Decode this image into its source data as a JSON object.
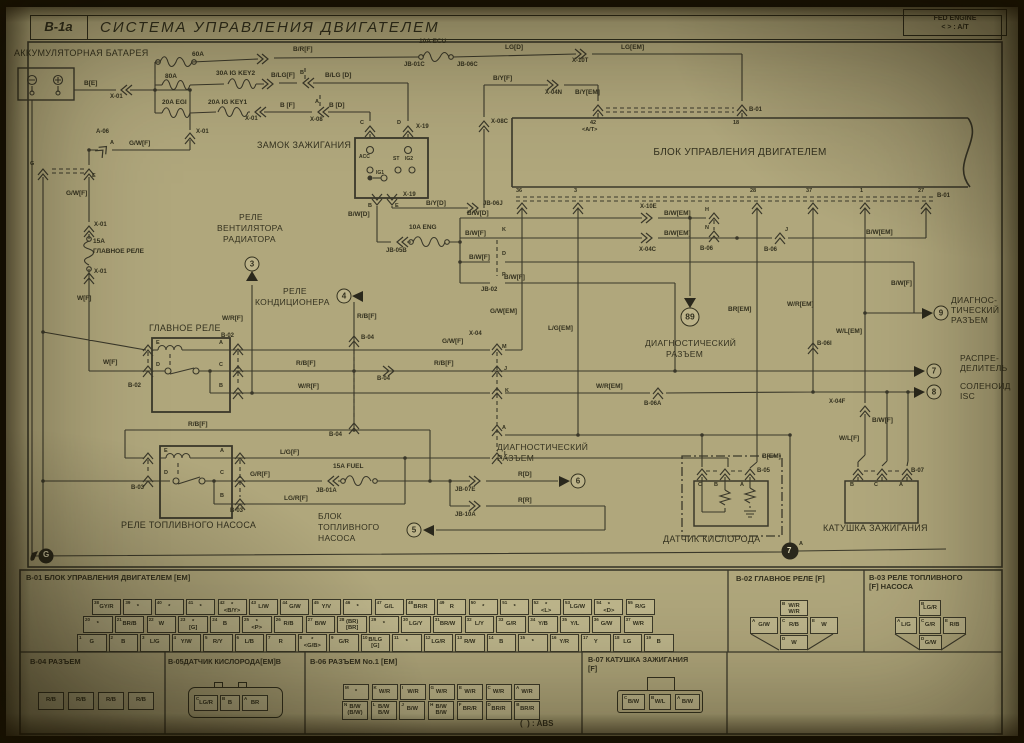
{
  "header": {
    "code": "B-1a",
    "title": "СИСТЕМА УПРАВЛЕНИЯ ДВИГАТЕЛЕМ",
    "corner1": "FED ENGINE",
    "corner2": "<  > : A/T"
  },
  "labels": [
    [
      "АККУМУЛЯТОРНАЯ БАТАРЕЯ",
      14,
      49,
      9,
      "r"
    ],
    [
      "60A",
      192,
      52,
      6.5
    ],
    [
      "B[E]",
      84,
      81
    ],
    [
      "X-01",
      110,
      94,
      6
    ],
    [
      "80A",
      165,
      74
    ],
    [
      "30A IG KEY2",
      216,
      71
    ],
    [
      "20A EGI",
      162,
      100
    ],
    [
      "20A IG KEY1",
      208,
      100
    ],
    [
      "X-01",
      245,
      116,
      6
    ],
    [
      "B [F]",
      280,
      103
    ],
    [
      "A",
      315,
      100,
      5.5
    ],
    [
      "X-08",
      310,
      117,
      6
    ],
    [
      "B [D]",
      329,
      103
    ],
    [
      "B",
      300,
      71,
      5.5
    ],
    [
      "B/LG[F]",
      271,
      73
    ],
    [
      "B/LG [D]",
      325,
      73
    ],
    [
      "B/R[F]",
      293,
      47
    ],
    [
      "10A ECU",
      419,
      39
    ],
    [
      "JB-01C",
      404,
      62,
      6
    ],
    [
      "JB-06C",
      457,
      62,
      6
    ],
    [
      "LG[D]",
      505,
      45
    ],
    [
      "X-10T",
      572,
      58,
      6
    ],
    [
      "LG[EM]",
      621,
      45
    ],
    [
      "B/Y[F]",
      493,
      76
    ],
    [
      "X-04N",
      545,
      90,
      6
    ],
    [
      "B/Y[EM]",
      575,
      90
    ],
    [
      "X-08C",
      491,
      119,
      6
    ],
    [
      "C",
      360,
      121,
      5.5
    ],
    [
      "D",
      397,
      121,
      5.5
    ],
    [
      "X-19",
      416,
      124,
      6
    ],
    [
      "ЗАМОК ЗАЖИГАНИЯ",
      257,
      141,
      9,
      "r"
    ],
    [
      "ACC",
      359,
      155,
      5
    ],
    [
      "IG1",
      376,
      171,
      5
    ],
    [
      "ST",
      393,
      157,
      5
    ],
    [
      "IG2",
      405,
      157,
      5
    ],
    [
      "B",
      368,
      204,
      5.5
    ],
    [
      "E",
      395,
      204,
      5.5
    ],
    [
      "X-19",
      403,
      192,
      6
    ],
    [
      "B/W[D]",
      348,
      212
    ],
    [
      "B/Y[D]",
      426,
      201
    ],
    [
      "JB-06J",
      483,
      201,
      6
    ],
    [
      "10A ENG",
      409,
      225
    ],
    [
      "JB-05B",
      386,
      248,
      6
    ],
    [
      "42",
      590,
      121,
      5.5
    ],
    [
      "<A/T>",
      582,
      128,
      5.5
    ],
    [
      "18",
      733,
      121,
      5.5
    ],
    [
      "B-01",
      749,
      107,
      6
    ],
    [
      "БЛОК УПРАВЛЕНИЯ ДВИГАТЕЛЕМ",
      740,
      148,
      10,
      "rc"
    ],
    [
      "36",
      516,
      189,
      5.5
    ],
    [
      "3",
      574,
      189,
      5.5
    ],
    [
      "28",
      750,
      189,
      5.5
    ],
    [
      "37",
      806,
      189,
      5.5
    ],
    [
      "1",
      860,
      189,
      5.5
    ],
    [
      "27",
      918,
      189,
      5.5
    ],
    [
      "B-01",
      937,
      193,
      6
    ],
    [
      "B/W[D]",
      467,
      211
    ],
    [
      "X-10E",
      640,
      204,
      6
    ],
    [
      "B/W[EM]",
      664,
      211
    ],
    [
      "H",
      705,
      208,
      5.5
    ],
    [
      "N",
      705,
      226,
      5.5
    ],
    [
      "B-06",
      700,
      246,
      6
    ],
    [
      "B/W[F]",
      465,
      231
    ],
    [
      "X-04C",
      639,
      247,
      6
    ],
    [
      "B/W[EM]",
      664,
      231
    ],
    [
      "J",
      785,
      228,
      5.5
    ],
    [
      "B-06",
      764,
      247,
      6
    ],
    [
      "B/W[EM]",
      866,
      230
    ],
    [
      "B/W[F]",
      469,
      255
    ],
    [
      "B/W[F]",
      504,
      275
    ],
    [
      "K",
      502,
      228,
      5.5
    ],
    [
      "D",
      502,
      252,
      5.5
    ],
    [
      "P",
      502,
      273,
      5.5
    ],
    [
      "JB-02",
      481,
      287,
      6
    ],
    [
      "G/W[EM]",
      490,
      309
    ],
    [
      "L/G[EM]",
      548,
      326
    ],
    [
      "BR[EM]",
      728,
      307
    ],
    [
      "W/R[EM]",
      787,
      302
    ],
    [
      "W/L[EM]",
      836,
      329
    ],
    [
      "B/W[F]",
      891,
      281
    ],
    [
      "B-06I",
      817,
      341,
      6
    ],
    [
      "B-06A",
      644,
      401,
      6
    ],
    [
      "W/R[EM]",
      596,
      384
    ],
    [
      "ДИАГНОСТИЧЕСКИЙ",
      645,
      339,
      8.5,
      "r"
    ],
    [
      "РАЗЪЕМ",
      666,
      350,
      8.5,
      "r"
    ],
    [
      "ДИАГНОС-",
      951,
      296,
      8.5,
      "r"
    ],
    [
      "ТИЧЕСКИЙ",
      951,
      306,
      8.5,
      "r"
    ],
    [
      "РАЗЪЕМ",
      951,
      316,
      8.5,
      "r"
    ],
    [
      "РАСПРЕ-",
      960,
      354,
      8.5,
      "r"
    ],
    [
      "ДЕЛИТЕЛЬ",
      960,
      364,
      8.5,
      "r"
    ],
    [
      "СОЛЕНОИД",
      960,
      382,
      8.5,
      "r"
    ],
    [
      "ISC",
      960,
      392,
      8.5,
      "r"
    ],
    [
      "X-04F",
      829,
      399,
      6
    ],
    [
      "W/L[F]",
      839,
      436
    ],
    [
      "B/W[F]",
      872,
      418
    ],
    [
      "B[EM]",
      762,
      454
    ],
    [
      "A",
      799,
      542,
      5.5
    ],
    [
      "7",
      787,
      547,
      8,
      "w"
    ],
    [
      "G",
      43,
      551,
      8,
      "w"
    ],
    [
      "A-06",
      96,
      129,
      6
    ],
    [
      "A",
      110,
      141,
      5.5
    ],
    [
      "G/W[F]",
      129,
      141
    ],
    [
      "X-01",
      196,
      129,
      6
    ],
    [
      "G",
      30,
      162,
      5.5
    ],
    [
      "E",
      92,
      174,
      5.5
    ],
    [
      "G/W[F]",
      66,
      191
    ],
    [
      "X-01",
      94,
      222,
      6
    ],
    [
      "15A",
      93,
      239
    ],
    [
      "ГЛАВНОЕ РЕЛЕ",
      93,
      249
    ],
    [
      "X-01",
      94,
      269,
      6
    ],
    [
      "W[F]",
      77,
      296
    ],
    [
      "РЕЛЕ",
      239,
      213,
      8.5,
      "r"
    ],
    [
      "ВЕНТИЛЯТОРА",
      217,
      224,
      8.5,
      "r"
    ],
    [
      "РАДИАТОРА",
      223,
      235,
      8.5,
      "r"
    ],
    [
      "W/R[F]",
      222,
      316
    ],
    [
      "ГЛАВНОЕ РЕЛЕ",
      149,
      324,
      9,
      "r"
    ],
    [
      "РЕЛЕ",
      283,
      287,
      8.5,
      "r"
    ],
    [
      "КОНДИЦИОНЕРА",
      255,
      298,
      8.5,
      "r"
    ],
    [
      "R/B[F]",
      357,
      314
    ],
    [
      "B-04",
      361,
      335,
      6
    ],
    [
      "E",
      156,
      341,
      5.5
    ],
    [
      "A",
      219,
      341,
      5.5
    ],
    [
      "D",
      156,
      363,
      5.5
    ],
    [
      "C",
      219,
      363,
      5.5
    ],
    [
      "B",
      219,
      384,
      5.5
    ],
    [
      "B-02",
      221,
      333,
      6
    ],
    [
      "B-02",
      128,
      383,
      6
    ],
    [
      "W[F]",
      103,
      360
    ],
    [
      "G/W[F]",
      442,
      339
    ],
    [
      "R/B[F]",
      296,
      361
    ],
    [
      "B-04",
      377,
      376,
      6
    ],
    [
      "R/B[F]",
      434,
      361
    ],
    [
      "W/R[F]",
      298,
      384
    ],
    [
      "M",
      502,
      345,
      5.5
    ],
    [
      "J",
      504,
      367,
      5.5
    ],
    [
      "K",
      505,
      389,
      5.5
    ],
    [
      "A",
      502,
      426,
      5.5
    ],
    [
      "L",
      504,
      452,
      5.5
    ],
    [
      "X-04",
      469,
      331,
      6
    ],
    [
      "B-04",
      329,
      432,
      6
    ],
    [
      "R/B[F]",
      188,
      422
    ],
    [
      "E",
      164,
      449,
      5.5
    ],
    [
      "A",
      220,
      449,
      5.5
    ],
    [
      "D",
      164,
      471,
      5.5
    ],
    [
      "C",
      220,
      471,
      5.5
    ],
    [
      "B",
      220,
      494,
      5.5
    ],
    [
      "B-03",
      131,
      485,
      6
    ],
    [
      "B-03",
      230,
      508,
      6
    ],
    [
      "L/G[F]",
      280,
      450
    ],
    [
      "G/R[F]",
      250,
      472
    ],
    [
      "15A FUEL",
      333,
      464
    ],
    [
      "JB-01A",
      316,
      488,
      6
    ],
    [
      "LG/R[F]",
      284,
      496
    ],
    [
      "JB-07E",
      455,
      487,
      6
    ],
    [
      "JB-10A",
      455,
      512,
      6
    ],
    [
      "R[D]",
      518,
      472
    ],
    [
      "R[R]",
      518,
      498
    ],
    [
      "РЕЛЕ ТОПЛИВНОГО НАСОСА",
      121,
      521,
      9,
      "r"
    ],
    [
      "БЛОК",
      318,
      512,
      8.5,
      "r"
    ],
    [
      "ТОПЛИВНОГО",
      318,
      523,
      8.5,
      "r"
    ],
    [
      "НАСОСА",
      318,
      534,
      8.5,
      "r"
    ],
    [
      "ДИАГНОСТИЧЕСКИЙ",
      497,
      443,
      8.5,
      "r"
    ],
    [
      "РАЗЪЕМ",
      497,
      454,
      8.5,
      "r"
    ],
    [
      "C",
      698,
      483,
      5.5
    ],
    [
      "B",
      714,
      483,
      5.5
    ],
    [
      "A",
      740,
      483,
      5.5
    ],
    [
      "B-05",
      757,
      468,
      6
    ],
    [
      "ДАТЧИК КИСЛОРОДА",
      663,
      535,
      9,
      "r"
    ],
    [
      "B",
      850,
      483,
      5.5
    ],
    [
      "C",
      874,
      483,
      5.5
    ],
    [
      "A",
      899,
      483,
      5.5
    ],
    [
      "B-07",
      911,
      468,
      6
    ],
    [
      "КАТУШКА ЗАЖИГАНИЯ",
      823,
      524,
      9,
      "r"
    ],
    [
      "B-01 БЛОК УПРАВЛЕНИЯ ДВИГАТЕЛЕМ [EM]",
      26,
      574,
      7.5
    ],
    [
      "B-02 ГЛАВНОЕ РЕЛЕ [F]",
      736,
      575,
      7.5
    ],
    [
      "B-03 РЕЛЕ ТОПЛИВНОГО",
      869,
      574,
      7.5
    ],
    [
      "[F] НАСОСА",
      869,
      583,
      7.5
    ],
    [
      "B-04 РАЗЪЕМ",
      30,
      658,
      7.5
    ],
    [
      "B-05ДАТЧИК КИСЛОРОДА[EM]B",
      168,
      658,
      7.2
    ],
    [
      "B-06 РАЗЪЕМ No.1 [EM]",
      310,
      658,
      7.5
    ],
    [
      "B-07 КАТУШКА ЗАЖИГАНИЯ",
      588,
      656,
      7.2
    ],
    [
      "[F]",
      588,
      665,
      7.2
    ],
    [
      "(  ) : ABS",
      520,
      720,
      8
    ]
  ],
  "circles": [
    [
      "3",
      252,
      264,
      ""
    ],
    [
      "4",
      344,
      296,
      ""
    ],
    [
      "89",
      690,
      317,
      "g"
    ],
    [
      "9",
      941,
      313,
      ""
    ],
    [
      "7",
      934,
      371,
      ""
    ],
    [
      "8",
      934,
      392,
      ""
    ],
    [
      "6",
      578,
      481,
      ""
    ],
    [
      "5",
      414,
      530,
      ""
    ]
  ],
  "legend": {
    "b01": {
      "rows": [
        {
          "x": 92,
          "y": 599,
          "w": 29,
          "step": 31.4,
          "h": 16,
          "start": 38,
          "labels": [
            "GY/R",
            "*",
            "*",
            "*",
            "*|<B/Y>",
            "L/W",
            "G/W",
            "Y/V",
            "*",
            "G/L",
            "BR/R",
            "R",
            "*",
            "*",
            "*|<L>",
            "LG/W",
            "*|<D>",
            "R/G"
          ]
        },
        {
          "x": 83,
          "y": 616,
          "w": 29.5,
          "step": 31.8,
          "h": 17,
          "start": 20,
          "labels": [
            "*",
            "BR/B",
            "W",
            "*|[G]",
            "B",
            "*|<P>",
            "R/B",
            "B/W",
            "(BR)|[BR]",
            "*",
            "LG/Y",
            "BR/W",
            "L/Y",
            "G/R",
            "Y/B",
            "Y/L",
            "G/W",
            "W/R"
          ]
        },
        {
          "x": 77,
          "y": 634,
          "w": 29.5,
          "step": 31.5,
          "h": 18,
          "start": 1,
          "labels": [
            "G",
            "B",
            "L/G",
            "Y/W",
            "R/Y",
            "L/B",
            "R",
            "*|<G/B>",
            "G/R",
            "B/LG|[G]",
            "*",
            "LG/R",
            "R/W",
            "B",
            "*",
            "Y/R",
            "Y",
            "LG",
            "B"
          ]
        }
      ]
    },
    "b02": {
      "cells": [
        {
          "x": 780,
          "y": 600,
          "w": 28,
          "h": 16,
          "l": "W/R|W/R",
          "p": "B"
        },
        {
          "x": 750,
          "y": 617,
          "w": 28,
          "h": 17,
          "l": "G/W",
          "p": "A"
        },
        {
          "x": 780,
          "y": 617,
          "w": 28,
          "h": 17,
          "l": "R/B",
          "p": "C"
        },
        {
          "x": 810,
          "y": 617,
          "w": 28,
          "h": 17,
          "l": "W",
          "p": "E"
        },
        {
          "x": 780,
          "y": 635,
          "w": 28,
          "h": 15,
          "l": "W",
          "p": "D"
        }
      ]
    },
    "b03": {
      "cells": [
        {
          "x": 919,
          "y": 600,
          "w": 22,
          "h": 16,
          "l": "LG/R",
          "p": "B"
        },
        {
          "x": 895,
          "y": 617,
          "w": 22,
          "h": 17,
          "l": "L/G",
          "p": "A"
        },
        {
          "x": 919,
          "y": 617,
          "w": 22,
          "h": 17,
          "l": "G/R",
          "p": "C"
        },
        {
          "x": 943,
          "y": 617,
          "w": 23,
          "h": 17,
          "l": "R/B",
          "p": "E"
        },
        {
          "x": 919,
          "y": 635,
          "w": 23,
          "h": 15,
          "l": "G/W",
          "p": "D"
        }
      ]
    },
    "b04": {
      "cells": [
        {
          "x": 38,
          "y": 692,
          "w": 26,
          "h": 18,
          "l": "R/B"
        },
        {
          "x": 68,
          "y": 692,
          "w": 26,
          "h": 18,
          "l": "R/B"
        },
        {
          "x": 98,
          "y": 692,
          "w": 26,
          "h": 18,
          "l": "R/B"
        },
        {
          "x": 128,
          "y": 692,
          "w": 26,
          "h": 18,
          "l": "R/B"
        }
      ]
    },
    "b05": {
      "cells": [
        {
          "x": 194,
          "y": 695,
          "w": 24,
          "h": 16,
          "l": "LG/R",
          "p": "C"
        },
        {
          "x": 220,
          "y": 695,
          "w": 20,
          "h": 16,
          "l": "B",
          "p": "B"
        },
        {
          "x": 242,
          "y": 695,
          "w": 26,
          "h": 16,
          "l": "BR",
          "p": "A"
        }
      ]
    },
    "b06": {
      "cells": [
        {
          "x": 343,
          "y": 684,
          "w": 26,
          "h": 16,
          "l": "*",
          "p": "M"
        },
        {
          "x": 371.5,
          "y": 684,
          "w": 26,
          "h": 16,
          "l": "W/R",
          "p": "K"
        },
        {
          "x": 400,
          "y": 684,
          "w": 26,
          "h": 16,
          "l": "W/R",
          "p": "I"
        },
        {
          "x": 428.5,
          "y": 684,
          "w": 26,
          "h": 16,
          "l": "W/R",
          "p": "G"
        },
        {
          "x": 457,
          "y": 684,
          "w": 26,
          "h": 16,
          "l": "W/R",
          "p": "E"
        },
        {
          "x": 485.5,
          "y": 684,
          "w": 26,
          "h": 16,
          "l": "W/R",
          "p": "C"
        },
        {
          "x": 514,
          "y": 684,
          "w": 26,
          "h": 16,
          "l": "W/R",
          "p": "A"
        },
        {
          "x": 342,
          "y": 701,
          "w": 26,
          "h": 19,
          "l": "B/W|(B/W)",
          "p": "N"
        },
        {
          "x": 370.7,
          "y": 701,
          "w": 26,
          "h": 19,
          "l": "B/W|B/W",
          "p": "L"
        },
        {
          "x": 399.4,
          "y": 701,
          "w": 26,
          "h": 19,
          "l": "B/W",
          "p": "J"
        },
        {
          "x": 428.1,
          "y": 701,
          "w": 26,
          "h": 19,
          "l": "B/W|B/W",
          "p": "H"
        },
        {
          "x": 456.8,
          "y": 701,
          "w": 26,
          "h": 19,
          "l": "BR/R",
          "p": "F"
        },
        {
          "x": 485.5,
          "y": 701,
          "w": 26,
          "h": 19,
          "l": "BR/R",
          "p": "D"
        },
        {
          "x": 514.2,
          "y": 701,
          "w": 26,
          "h": 19,
          "l": "BR/R",
          "p": "B"
        }
      ]
    },
    "b07": {
      "cells": [
        {
          "x": 622,
          "y": 694,
          "w": 23,
          "h": 16,
          "l": "B/W",
          "p": "C"
        },
        {
          "x": 649,
          "y": 694,
          "w": 22,
          "h": 16,
          "l": "W/L",
          "p": "B"
        },
        {
          "x": 675,
          "y": 694,
          "w": 25,
          "h": 16,
          "l": "B/W",
          "p": "A"
        }
      ]
    }
  }
}
